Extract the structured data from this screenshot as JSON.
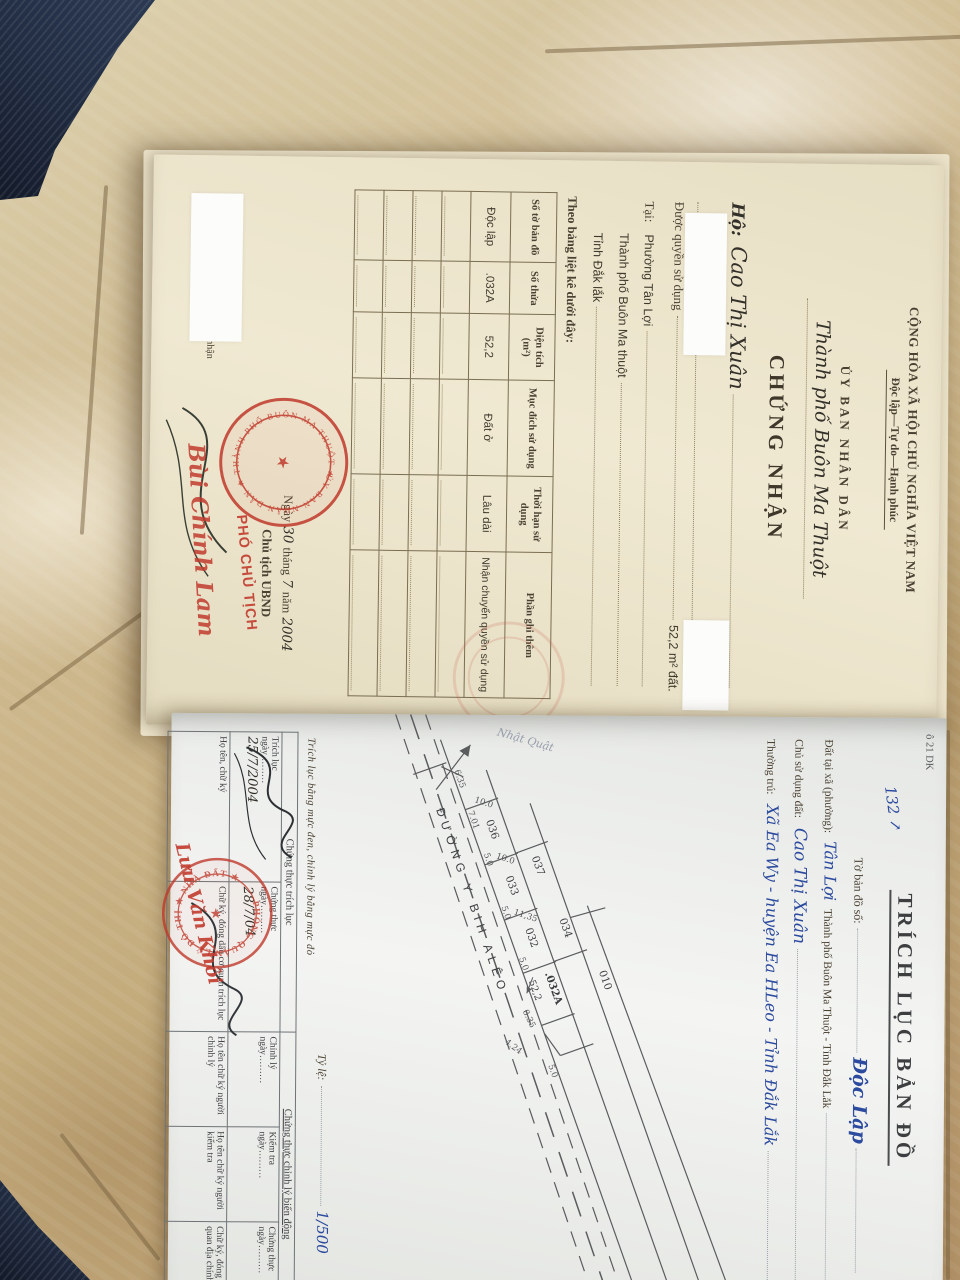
{
  "certificate": {
    "header": {
      "country": "CỘNG HÒA XÃ HỘI CHỦ NGHĨA VIỆT NAM",
      "motto": "Độc lập—Tự do—Hạnh phúc"
    },
    "issuer": "ỦY BAN NHÂN DÂN",
    "issuer_city": "Thành phố Buôn Ma Thuột",
    "title": "CHỨNG NHẬN",
    "holder_label": "Hộ:",
    "holder_name": "Cao Thị Xuân",
    "grant_label": "Được quyền sử dụng",
    "grant_value": "52,2 m² đất.",
    "at_label": "Tại:",
    "address": [
      "Phường Tân Lợi",
      "Thành phố Buôn Ma thuột",
      "Tỉnh Đắk lắk"
    ],
    "table_intro": "Theo bảng liệt kê dưới đây:",
    "table": {
      "headers": [
        "Số tờ bản đồ",
        "Số thửa",
        "Diện tích (m²)",
        "Mục đích sử dụng",
        "Thời hạn sử dụng",
        "Phần ghi thêm"
      ],
      "row": [
        "Độc lập",
        ".032A",
        "52,2",
        "Đất ở",
        "Lâu dài",
        "Nhận chuyển quyền sử dụng"
      ]
    },
    "date": {
      "prefix": "Ngày",
      "day": "30",
      "thang": "tháng",
      "month": "7",
      "nam": "năm",
      "year": "2004"
    },
    "signer_title": "Chủ tịch UBND",
    "stamp_text": "PHÓ CHỦ TỊCH",
    "seal_text": "ỦY BAN NHÂN DÂN ★ THÀNH PHỐ BUÔN MA THUỘT ★",
    "signature_name": "Bùi Chính Lam",
    "register_note": "Vào sổ cấp giấy chứng nhận"
  },
  "map_page": {
    "corner_code": "ô 21 DK",
    "margin_note": "132 ↗",
    "title": "TRÍCH LỤC BẢN ĐỒ",
    "fields": {
      "sheet_label": "Tờ bản đồ số:",
      "sheet_value": "Độc Lập",
      "location_label": "Đất tại xã (phường):",
      "location_value": "Tân Lợi",
      "location_suffix": "Thành phố Buôn Ma Thuột - Tỉnh Đắk Lắk",
      "owner_label": "Chủ sử dụng đất:",
      "owner_value": "Cao Thị Xuân",
      "residence_label": "Thường trú:",
      "residence_value": "Xã Ea Wy - huyện Ea HLeo - Tỉnh Đắk Lắk",
      "scale_label": "Tỷ lệ:",
      "scale_value": "1/500"
    },
    "ink_note": "Trích lục bằng mực đen, chỉnh lý bằng mực đỏ",
    "sketch": {
      "road_label": "ĐƯỜNG Y BIH ALÊO",
      "pencil_note": "Nhật Quật",
      "parcels": [
        "037",
        "036",
        "034",
        "033",
        "032",
        ".032A",
        "010"
      ],
      "area_label": "52,2",
      "dimensions": [
        "6.35",
        "7.01",
        "5.0",
        "10.0",
        "10.0",
        "11,35",
        "5.0",
        "5.0",
        "8.35",
        "4.24",
        "5.0"
      ]
    },
    "cert_table": {
      "group_left": "Chứng thực trích lục",
      "group_right": "Chứng thực chỉnh lý biến động",
      "cells": {
        "trich_luc": "Trích lục",
        "chung_thuc": "Chứng thực",
        "chinh_ly": "Chỉnh lý",
        "kiem_tra": "Kiểm tra",
        "ngay": "ngày………",
        "date1": "25/7/2004",
        "date2": "28/7/04",
        "ho_ten": "Họ tên, chữ ký",
        "stamp_cell": "Chữ ký, đóng dấu cơ quan trích lục",
        "nguoi_chinh_ly": "Họ tên chữ ký người chỉnh lý",
        "nguoi_kiem_tra": "Họ tên chữ ký người kiểm tra",
        "co_quan_dia_chinh": "Chữ ký, đóng dấu cơ quan địa chính"
      },
      "round_stamp": "PHÒNG QUẢN LÝ ĐÔ THỊ ★ NHÀ ĐẤT ★",
      "red_name": "Lưu Văn Khôi"
    }
  }
}
